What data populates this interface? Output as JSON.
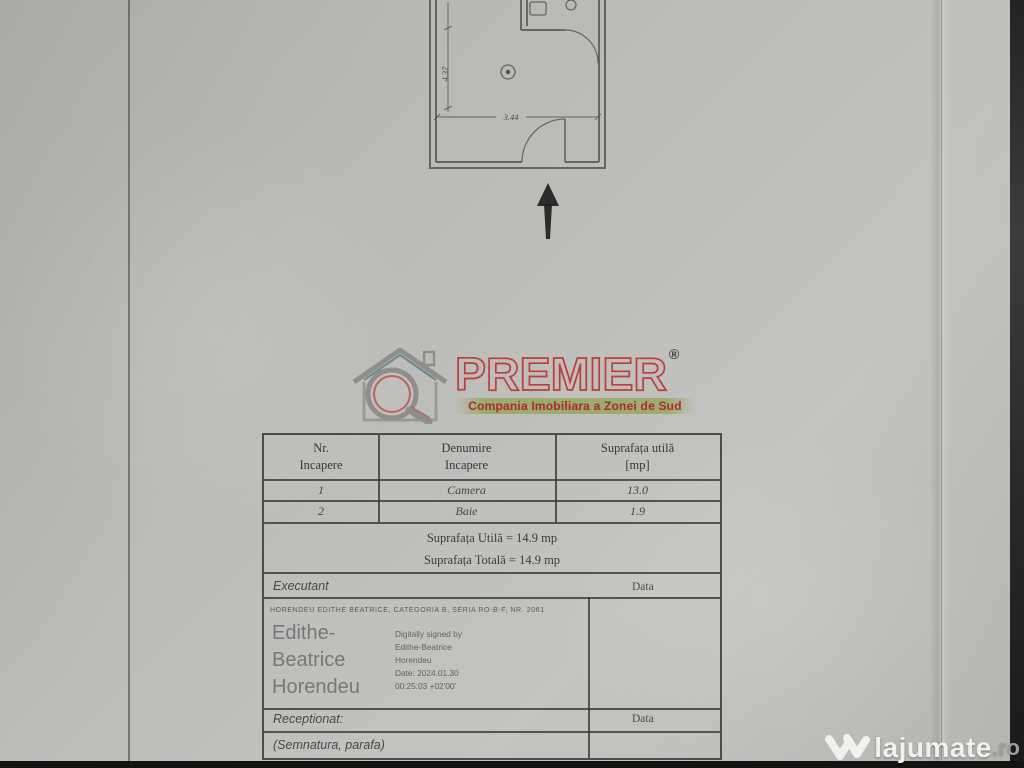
{
  "floor_plan": {
    "dim_height": "4.37",
    "dim_width": "3.44"
  },
  "logo": {
    "brand": "PREMIER",
    "registered": "®",
    "tagline": "Compania Imobiliara a Zonei de Sud"
  },
  "table": {
    "header": {
      "col1_line1": "Nr.",
      "col1_line2": "Incapere",
      "col2_line1": "Denumire",
      "col2_line2": "Incapere",
      "col3_line1": "Suprafața utilă",
      "col3_line2": "[mp]"
    },
    "rows": [
      {
        "nr": "1",
        "name": "Camera",
        "area": "13.0"
      },
      {
        "nr": "2",
        "name": "Baie",
        "area": "1.9"
      }
    ],
    "summary": {
      "line1": "Suprafața Utilă = 14.9 mp",
      "line2": "Suprafața Totală = 14.9 mp"
    },
    "executant": {
      "label": "Executant",
      "data_label": "Data"
    },
    "signature": {
      "cert_line": "HORENDEU EDITHE BEATRICE, CATEGORIA B, SERIA RO-B-F, NR. 2061",
      "name_line1": "Edithe-",
      "name_line2": "Beatrice",
      "name_line3": "Horendeu",
      "digital_line1": "Digitally signed by",
      "digital_line2": "Edithe-Beatrice",
      "digital_line3": "Horendeu",
      "digital_line4": "Date: 2024.01.30",
      "digital_line5": "00:25:03 +02'00'"
    },
    "receptionat": {
      "label": "Receptionat:",
      "data_label": "Data"
    },
    "semnatura_label": "(Semnatura, parafa)"
  },
  "watermark": {
    "brand": "lajumate",
    "tld": ".ro"
  }
}
